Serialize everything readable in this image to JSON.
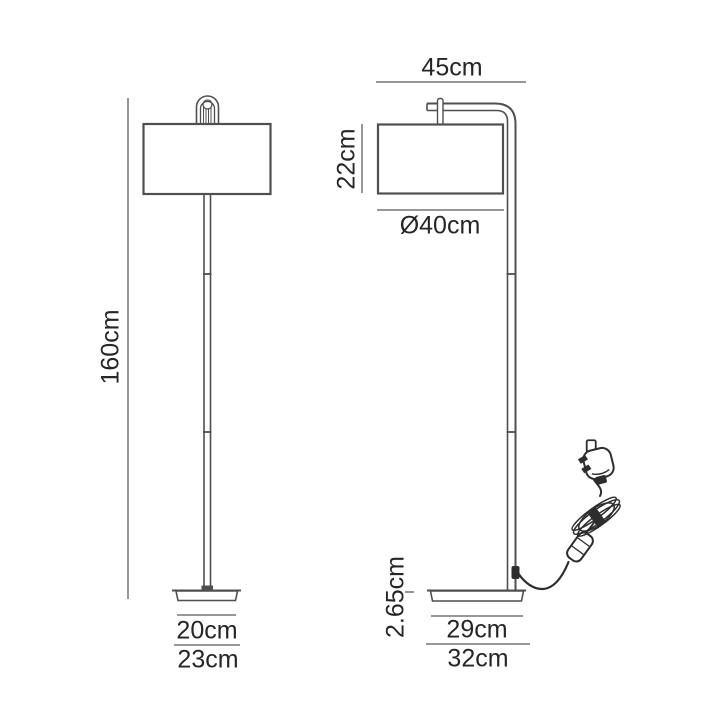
{
  "diagram": {
    "title": "floor lamp dimension drawing, front and side views",
    "colors": {
      "background": "#ffffff",
      "line": "#4f4f4f",
      "dim_line": "#8a8a8a",
      "text": "#262626",
      "cord": "#2d2d2d"
    },
    "front_view": {
      "labels": {
        "total_height": "160cm",
        "base_inner_width": "20cm",
        "base_outer_width": "23cm"
      }
    },
    "side_view": {
      "labels": {
        "arm_depth": "45cm",
        "shade_height": "22cm",
        "shade_diameter": "Ø40cm",
        "base_thickness": "2.65cm",
        "base_inner_depth": "29cm",
        "base_outer_depth": "32cm"
      }
    }
  }
}
